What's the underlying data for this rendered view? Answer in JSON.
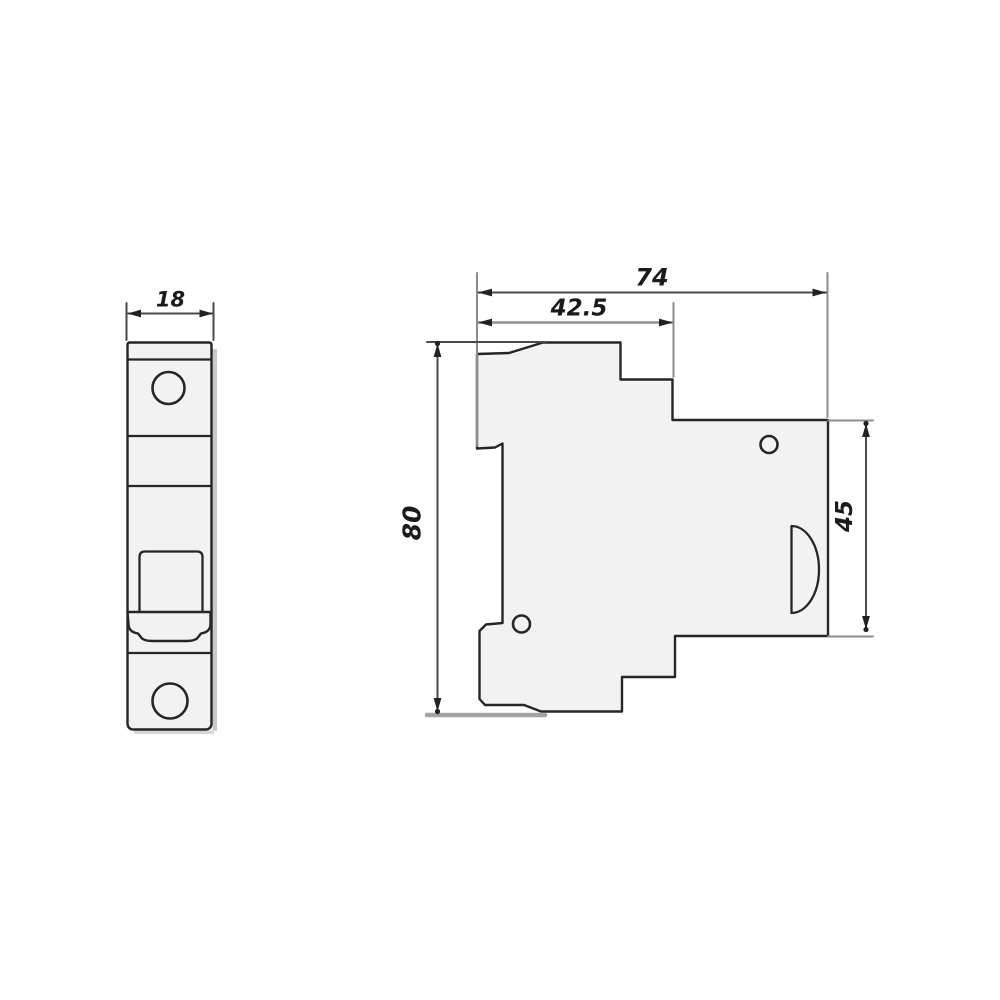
{
  "canvas": {
    "width": 1000,
    "height": 1000,
    "background": "#ffffff"
  },
  "diagram": {
    "kind": "engineering-dimension-drawing",
    "subject": "DIN-rail miniature circuit breaker outline, front and side views",
    "front_view": {
      "width_label": "18"
    },
    "side_view": {
      "total_width_label": "74",
      "upper_width_label": "42.5",
      "height_label": "80",
      "right_height_label": "45"
    },
    "colors": {
      "outline": "#262626",
      "dimension_line": "#4a4a4a",
      "extension_line": "#8c8c8c",
      "body_fill": "#f2f2f3",
      "shadow": "#c9c9c9",
      "text": "#1b1b1b"
    }
  }
}
